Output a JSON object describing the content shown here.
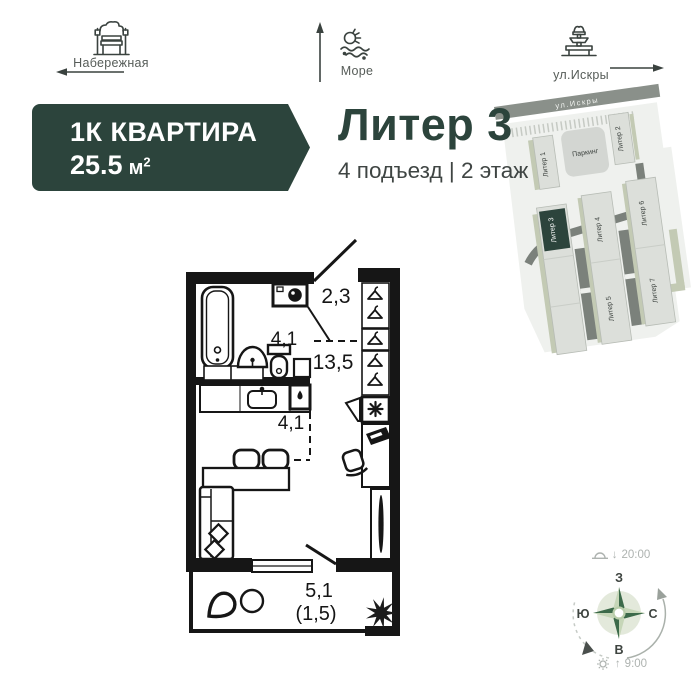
{
  "landmarks": {
    "embankment": {
      "label": "Набережная"
    },
    "sea": {
      "label": "Море"
    },
    "street": {
      "label": "ул.Искры"
    }
  },
  "header": {
    "apartment_type": "1К КВАРТИРА",
    "area_value": "25.5",
    "area_unit": "м",
    "area_sup": "2",
    "building_title": "Литер 3",
    "entrance_floor": "4 подъезд | 2 этаж"
  },
  "site_plan": {
    "street_label": "ул.Искры",
    "parking_label": "Паркинг",
    "highlighted_building": "Литер 3",
    "buildings": [
      {
        "label": "Литер 1"
      },
      {
        "label": "Литер 2"
      },
      {
        "label": "Литер 3"
      },
      {
        "label": "Литер 4"
      },
      {
        "label": "Литер 5"
      },
      {
        "label": "Литер 6"
      },
      {
        "label": "Литер 7"
      }
    ]
  },
  "floor_plan": {
    "hallway_area": "2,3",
    "room_area": "13,5",
    "bathroom_area": "4,1",
    "kitchen_area": "4,1",
    "balcony_area": "5,1",
    "balcony_area_reduced": "(1,5)"
  },
  "compass": {
    "west": "З",
    "north": "С",
    "east": "В",
    "south": "Ю",
    "sunset_arrow": "↓",
    "sunset_time": "20:00",
    "sunrise_arrow": "↑",
    "sunrise_time": "9:00"
  },
  "colors": {
    "accent_green": "#2c443c",
    "text_dark": "#3f4543",
    "wall_black": "#161616",
    "road_grey": "#8a908a",
    "building_grey": "#dcdfda",
    "sage_green": "#c3cab4",
    "compass_light": "#c6d6b8",
    "compass_dark": "#3c6a4a"
  }
}
